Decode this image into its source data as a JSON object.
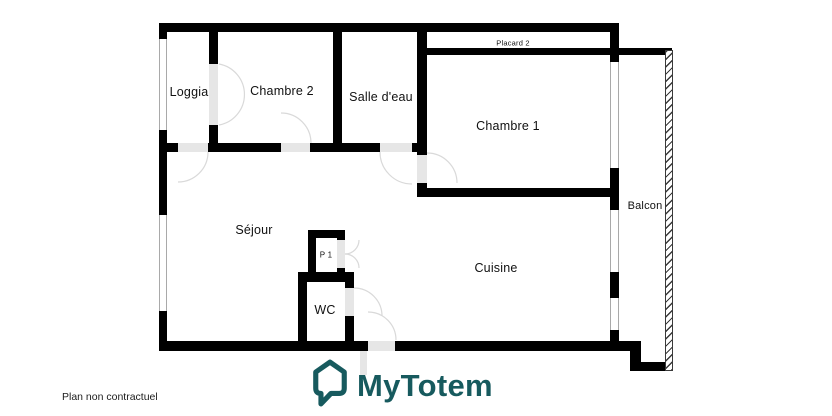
{
  "plan": {
    "labels": {
      "loggia": "Loggia",
      "chambre2": "Chambre 2",
      "salle_deau": "Salle d'eau",
      "chambre1": "Chambre 1",
      "placard2": "Placard 2",
      "sejour": "Séjour",
      "p1": "P 1",
      "wc": "WC",
      "cuisine": "Cuisine",
      "balcon": "Balcon"
    },
    "disclaimer": "Plan non contractuel"
  },
  "logo": {
    "text": "MyTotem"
  },
  "colors": {
    "wall": "#000000",
    "door_gap": "#e6e6e6",
    "door_arc": "#d9d9d9",
    "brand_teal": "#175a5e"
  }
}
